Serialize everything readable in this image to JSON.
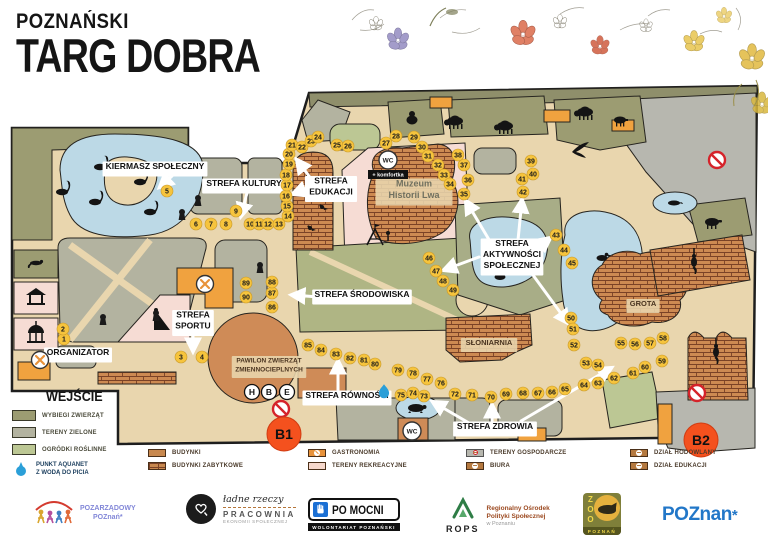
{
  "title": {
    "line1": "POZNAŃSKI",
    "line2": "TARG DOBRA"
  },
  "map": {
    "zone_labels": [
      {
        "id": "kiermasz",
        "lines": [
          "KIERMASZ SPOŁECZNY"
        ],
        "x": 155,
        "y": 169,
        "style": "zone"
      },
      {
        "id": "kultury",
        "lines": [
          "STREFA KULTURY"
        ],
        "x": 244,
        "y": 186,
        "style": "zone"
      },
      {
        "id": "edukacji",
        "lines": [
          "STREFA",
          "EDUKACJI"
        ],
        "x": 331,
        "y": 189,
        "style": "zone"
      },
      {
        "id": "aktywnosci",
        "lines": [
          "STREFA",
          "AKTYWNOŚCI",
          "SPOŁECZNEJ"
        ],
        "x": 512,
        "y": 257,
        "style": "zone"
      },
      {
        "id": "srodowiska",
        "lines": [
          "STREFA ŚRODOWISKA"
        ],
        "x": 362,
        "y": 297,
        "style": "zone"
      },
      {
        "id": "sportu",
        "lines": [
          "STREFA",
          "SPORTU"
        ],
        "x": 193,
        "y": 323,
        "style": "zone"
      },
      {
        "id": "organizator",
        "lines": [
          "ORGANIZATOR"
        ],
        "x": 78,
        "y": 355,
        "style": "zone"
      },
      {
        "id": "rownosci",
        "lines": [
          "STREFA RÓWNOŚCI"
        ],
        "x": 347,
        "y": 398,
        "style": "zone"
      },
      {
        "id": "zdrowia",
        "lines": [
          "STREFA ZDROWIA"
        ],
        "x": 495,
        "y": 429,
        "style": "zone"
      },
      {
        "id": "muzeum",
        "lines": [
          "Muzeum",
          "Historii Lwa"
        ],
        "x": 414,
        "y": 192,
        "style": "muted"
      },
      {
        "id": "sloniarnia",
        "lines": [
          "SŁONIARNIA"
        ],
        "x": 489,
        "y": 345,
        "style": "place"
      },
      {
        "id": "grota",
        "lines": [
          "GROTA"
        ],
        "x": 643,
        "y": 306,
        "style": "place"
      },
      {
        "id": "pawilon",
        "lines": [
          "PAWILON ZWIERZĄT",
          "ZMIENNOCIEPLNYCH"
        ],
        "x": 269,
        "y": 367,
        "style": "building"
      }
    ],
    "arrows": [
      [
        172,
        176,
        160,
        187
      ],
      [
        247,
        193,
        241,
        216
      ],
      [
        312,
        180,
        297,
        160
      ],
      [
        306,
        189,
        293,
        194
      ],
      [
        491,
        243,
        466,
        201
      ],
      [
        518,
        240,
        522,
        200
      ],
      [
        536,
        249,
        550,
        238
      ],
      [
        479,
        257,
        444,
        270
      ],
      [
        530,
        271,
        568,
        323
      ],
      [
        319,
        297,
        292,
        295
      ],
      [
        193,
        335,
        193,
        351
      ],
      [
        338,
        390,
        338,
        361
      ],
      [
        469,
        423,
        433,
        402
      ],
      [
        492,
        422,
        492,
        405
      ],
      [
        521,
        421,
        611,
        368
      ]
    ],
    "markers": [
      [
        1,
        64,
        339
      ],
      [
        2,
        63,
        329
      ],
      [
        3,
        181,
        357
      ],
      [
        4,
        202,
        357
      ],
      [
        5,
        167,
        191
      ],
      [
        6,
        196,
        224
      ],
      [
        7,
        211,
        224
      ],
      [
        8,
        226,
        224
      ],
      [
        9,
        236,
        211
      ],
      [
        10,
        250,
        224
      ],
      [
        11,
        259,
        224
      ],
      [
        12,
        268,
        224
      ],
      [
        13,
        279,
        224
      ],
      [
        14,
        288,
        216
      ],
      [
        15,
        287,
        206
      ],
      [
        16,
        286,
        196
      ],
      [
        17,
        287,
        185
      ],
      [
        18,
        286,
        175
      ],
      [
        19,
        289,
        164
      ],
      [
        20,
        289,
        154
      ],
      [
        21,
        292,
        145
      ],
      [
        22,
        302,
        147
      ],
      [
        23,
        311,
        141
      ],
      [
        24,
        318,
        137
      ],
      [
        25,
        337,
        145
      ],
      [
        26,
        348,
        146
      ],
      [
        27,
        386,
        143
      ],
      [
        28,
        396,
        136
      ],
      [
        29,
        414,
        137
      ],
      [
        30,
        422,
        147
      ],
      [
        31,
        428,
        156
      ],
      [
        32,
        438,
        165
      ],
      [
        33,
        444,
        175
      ],
      [
        34,
        450,
        184
      ],
      [
        35,
        464,
        194
      ],
      [
        36,
        468,
        180
      ],
      [
        37,
        464,
        165
      ],
      [
        38,
        458,
        155
      ],
      [
        39,
        531,
        161
      ],
      [
        40,
        533,
        174
      ],
      [
        41,
        522,
        179
      ],
      [
        42,
        523,
        192
      ],
      [
        43,
        556,
        235
      ],
      [
        44,
        564,
        250
      ],
      [
        45,
        572,
        263
      ],
      [
        46,
        429,
        258
      ],
      [
        47,
        436,
        271
      ],
      [
        48,
        443,
        281
      ],
      [
        49,
        453,
        290
      ],
      [
        50,
        571,
        318
      ],
      [
        51,
        573,
        329
      ],
      [
        52,
        574,
        345
      ],
      [
        53,
        586,
        363
      ],
      [
        54,
        598,
        365
      ],
      [
        55,
        621,
        343
      ],
      [
        56,
        635,
        344
      ],
      [
        57,
        650,
        343
      ],
      [
        58,
        663,
        338
      ],
      [
        59,
        662,
        361
      ],
      [
        60,
        645,
        367
      ],
      [
        61,
        633,
        373
      ],
      [
        62,
        614,
        378
      ],
      [
        63,
        598,
        383
      ],
      [
        64,
        584,
        385
      ],
      [
        65,
        565,
        389
      ],
      [
        66,
        552,
        392
      ],
      [
        67,
        538,
        393
      ],
      [
        68,
        523,
        393
      ],
      [
        69,
        506,
        394
      ],
      [
        70,
        491,
        397
      ],
      [
        71,
        472,
        395
      ],
      [
        72,
        455,
        394
      ],
      [
        73,
        424,
        396
      ],
      [
        74,
        413,
        393
      ],
      [
        75,
        401,
        395
      ],
      [
        76,
        441,
        383
      ],
      [
        77,
        427,
        379
      ],
      [
        78,
        413,
        373
      ],
      [
        79,
        398,
        370
      ],
      [
        80,
        375,
        364
      ],
      [
        81,
        364,
        360
      ],
      [
        82,
        350,
        358
      ],
      [
        83,
        336,
        354
      ],
      [
        84,
        321,
        350
      ],
      [
        85,
        308,
        345
      ],
      [
        86,
        272,
        307
      ],
      [
        87,
        272,
        293
      ],
      [
        88,
        272,
        282
      ],
      [
        89,
        246,
        283
      ],
      [
        90,
        246,
        297
      ]
    ],
    "b_markers": [
      {
        "label": "B1",
        "x": 284,
        "y": 434
      },
      {
        "label": "B2",
        "x": 701,
        "y": 440
      }
    ],
    "wc": [
      {
        "x": 388,
        "y": 160,
        "label": "WC",
        "note": "+ komfortka"
      },
      {
        "x": 412,
        "y": 431,
        "label": "WC"
      }
    ],
    "letters": [
      {
        "t": "H",
        "x": 252,
        "y": 392
      },
      {
        "t": "B",
        "x": 269,
        "y": 392
      },
      {
        "t": "E",
        "x": 287,
        "y": 392
      }
    ],
    "no_entry": [
      [
        717,
        160
      ],
      [
        281,
        409
      ],
      [
        697,
        393
      ]
    ],
    "gastro_points": [
      [
        205,
        284
      ],
      [
        40,
        360
      ]
    ],
    "water_points": [
      [
        384,
        391
      ]
    ],
    "keyholes": [
      [
        198,
        198
      ],
      [
        182,
        212
      ],
      [
        103,
        317
      ],
      [
        156,
        313
      ],
      [
        260,
        265
      ]
    ],
    "animals": [
      [
        "swan",
        100,
        165
      ],
      [
        "swan",
        140,
        180
      ],
      [
        "swan",
        95,
        200
      ],
      [
        "swan",
        150,
        210
      ],
      [
        "swan",
        62,
        190
      ],
      [
        "duck",
        500,
        277
      ],
      [
        "duck",
        602,
        258
      ],
      [
        "gorilla",
        412,
        118
      ],
      [
        "bison",
        455,
        121
      ],
      [
        "bison",
        505,
        126
      ],
      [
        "bison",
        585,
        112
      ],
      [
        "boar",
        620,
        120
      ],
      [
        "eagle",
        572,
        152
      ],
      [
        "tapir",
        712,
        222
      ],
      [
        "seal",
        674,
        203
      ],
      [
        "otter",
        36,
        263
      ],
      [
        "turtle",
        416,
        408
      ],
      [
        "monkey",
        694,
        262
      ],
      [
        "monkey",
        716,
        352
      ],
      [
        "bird",
        308,
        175
      ],
      [
        "bird",
        322,
        207
      ],
      [
        "bird",
        310,
        228
      ],
      [
        "gazebo",
        36,
        297
      ],
      [
        "carousel",
        36,
        333
      ],
      [
        "playground",
        375,
        237
      ],
      [
        "slide",
        162,
        322
      ]
    ]
  },
  "legend_entrance": {
    "title": "WEJŚCIE",
    "items": [
      {
        "label": "WYBIEGI ZWIERZĄT",
        "color": "#9c9c72"
      },
      {
        "label": "TERENY ZIELONE",
        "color": "#b3b3a0"
      },
      {
        "label": "OGRÓDKI ROŚLINNE",
        "color": "#bcc794"
      }
    ],
    "water_lines": [
      "PUNKT AQUANET",
      "Z WODĄ DO PICIA"
    ]
  },
  "legend_buildings": {
    "items": [
      {
        "label": "BUDYNKI",
        "type": "plain"
      },
      {
        "label": "BUDYNKI ZABYTKOWE",
        "type": "brick"
      },
      {
        "label": "GASTRONOMIA",
        "type": "gastro"
      },
      {
        "label": "TERENY REKREACYJNE",
        "type": "pink"
      },
      {
        "label": "TERENY GOSPODARCZE",
        "type": "gray"
      },
      {
        "label": "BIURA",
        "type": "info"
      },
      {
        "label": "DZIAŁ HODOWLANY",
        "type": "hod"
      },
      {
        "label": "DZIAŁ EDUKACJI",
        "type": "edu"
      }
    ],
    "columns": [
      148,
      308,
      466,
      630
    ]
  },
  "footer": {
    "pozarzadowy": {
      "line1": "POZARZĄDOWY",
      "line2": "POZnań*"
    },
    "pracownia": {
      "script": "ładne rzeczy",
      "name": "PRACOWNIA",
      "sub": "EKONOMII SPOŁECZNEJ"
    },
    "pomocni": {
      "plate": "PO MOCNI",
      "sub": "WOLONTARIAT POZNAŃSKI"
    },
    "rops": {
      "abbr": "ROPS",
      "line1": "Regionalny Ośrodek",
      "line2": "Polityki Społecznej",
      "sub": "w Poznaniu"
    },
    "zoo": {
      "name": "ZOO",
      "city": "POZNAŃ"
    },
    "poznan": {
      "text": "POZnan",
      "star": "*"
    }
  },
  "colors": {
    "marker_yellow": "#f6c43d",
    "b_orange": "#f4511e",
    "path_tan": "#e9d6ae",
    "green_dark": "#9c9c72",
    "green_gray": "#b3b3a0",
    "green_light": "#bcc794",
    "pink": "#f6dcd4",
    "orange_building": "#f0a23f",
    "brick": "#cd8a52",
    "water": "#bcd9e6",
    "gray": "#b7b7af"
  }
}
